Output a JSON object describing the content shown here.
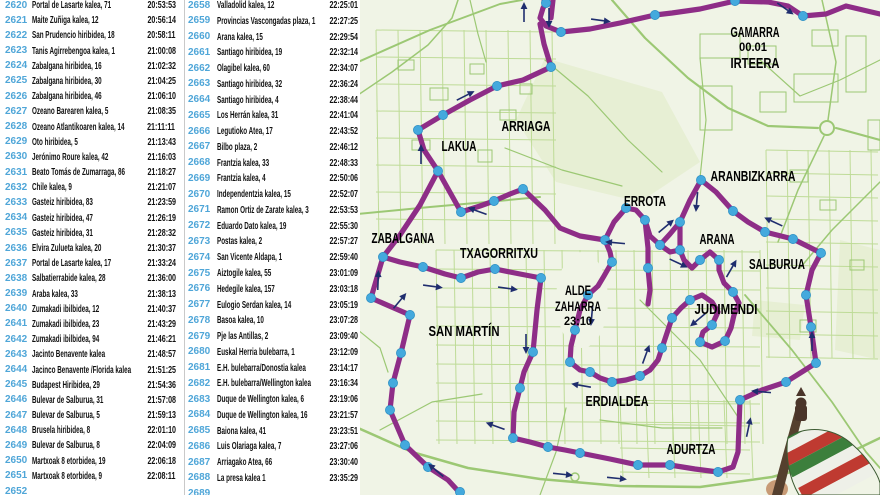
{
  "table": {
    "left_rows": [
      {
        "num": "2620",
        "name": "Portal de Lasarte kalea, 71",
        "time": "20:53:53"
      },
      {
        "num": "2621",
        "name": "Maite Zuñiga kalea, 12",
        "time": "20:56:14"
      },
      {
        "num": "2622",
        "name": "San Prudencio hiribidea, 18",
        "time": "20:58:11"
      },
      {
        "num": "2623",
        "name": "Tanis Agirrebengoa kalea, 1",
        "time": "21:00:08"
      },
      {
        "num": "2624",
        "name": "Zabalgana hiribidea, 16",
        "time": "21:02:32"
      },
      {
        "num": "2625",
        "name": "Zabalgana hiribidea, 30",
        "time": "21:04:25"
      },
      {
        "num": "2626",
        "name": "Zabalgana hiribidea, 46",
        "time": "21:06:10"
      },
      {
        "num": "2627",
        "name": "Ozeano Barearen kalea, 5",
        "time": "21:08:35"
      },
      {
        "num": "2628",
        "name": "Ozeano Atlantikoaren kalea, 14",
        "time": "21:11:11"
      },
      {
        "num": "2629",
        "name": "Oto hiribidea, 5",
        "time": "21:13:43"
      },
      {
        "num": "2630",
        "name": "Jerónimo Roure kalea, 42",
        "time": "21:16:03"
      },
      {
        "num": "2631",
        "name": "Beato Tomás de Zumarraga, 86",
        "time": "21:18:27"
      },
      {
        "num": "2632",
        "name": "Chile kalea, 9",
        "time": "21:21:07"
      },
      {
        "num": "2633",
        "name": "Gasteiz hiribidea, 83",
        "time": "21:23:59"
      },
      {
        "num": "2634",
        "name": "Gasteiz hiribidea, 47",
        "time": "21:26:19"
      },
      {
        "num": "2635",
        "name": "Gasteiz hiribidea, 31",
        "time": "21:28:32"
      },
      {
        "num": "2636",
        "name": "Elvira Zulueta kalea, 20",
        "time": "21:30:37"
      },
      {
        "num": "2637",
        "name": "Portal de Lasarte kalea, 17",
        "time": "21:33:24"
      },
      {
        "num": "2638",
        "name": "Salbatierrabide kalea, 28",
        "time": "21:36:00"
      },
      {
        "num": "2639",
        "name": "Araba kalea, 33",
        "time": "21:38:13"
      },
      {
        "num": "2640",
        "name": "Zumakadi ibilbidea, 12",
        "time": "21:40:37"
      },
      {
        "num": "2641",
        "name": "Zumakadi ibilbidea, 23",
        "time": "21:43:29"
      },
      {
        "num": "2642",
        "name": "Zumakadi ibilbidea, 94",
        "time": "21:46:21"
      },
      {
        "num": "2643",
        "name": "Jacinto Benavente kalea",
        "time": "21:48:57"
      },
      {
        "num": "2644",
        "name": "Jacinco Benavente /Florida kalea",
        "time": "21:51:25"
      },
      {
        "num": "2645",
        "name": "Budapest Hiribidea, 29",
        "time": "21:54:36"
      },
      {
        "num": "2646",
        "name": "Bulevar de Salburua, 31",
        "time": "21:57:08"
      },
      {
        "num": "2647",
        "name": "Bulevar de Salburua, 5",
        "time": "21:59:13"
      },
      {
        "num": "2648",
        "name": "Brusela hiribidea, 8",
        "time": "22:01:10"
      },
      {
        "num": "2649",
        "name": "Bulevar de Salburua, 8",
        "time": "22:04:09"
      },
      {
        "num": "2650",
        "name": "Martxoak 8 etorbidea, 19",
        "time": "22:06:18"
      },
      {
        "num": "2651",
        "name": "Martxoak 8 etorbidea, 9",
        "time": "22:08:11"
      }
    ],
    "left_partial": {
      "num": "2652",
      "name": "",
      "time": ""
    },
    "right_rows": [
      {
        "num": "2658",
        "name": "Valladolid kalea, 12",
        "time": "22:25:01"
      },
      {
        "num": "2659",
        "name": "Provincias Vascongadas plaza, 1",
        "time": "22:27:25"
      },
      {
        "num": "2660",
        "name": "Arana kalea, 15",
        "time": "22:29:54"
      },
      {
        "num": "2661",
        "name": "Santiago hiribidea, 19",
        "time": "22:32:14"
      },
      {
        "num": "2662",
        "name": "Olagibel kalea, 60",
        "time": "22:34:07"
      },
      {
        "num": "2663",
        "name": "Santiago hiribidea, 32",
        "time": "22:36:24"
      },
      {
        "num": "2664",
        "name": "Santiago hiribidea, 4",
        "time": "22:38:44"
      },
      {
        "num": "2665",
        "name": "Los Herrán kalea, 31",
        "time": "22:41:04"
      },
      {
        "num": "2666",
        "name": "Legutioko Atea, 17",
        "time": "22:43:52"
      },
      {
        "num": "2667",
        "name": "Bilbo plaza, 2",
        "time": "22:46:12"
      },
      {
        "num": "2668",
        "name": "Frantzia kalea, 33",
        "time": "22:48:33"
      },
      {
        "num": "2669",
        "name": "Frantzia kalea, 4",
        "time": "22:50:06"
      },
      {
        "num": "2670",
        "name": "Independentzia kalea, 15",
        "time": "22:52:07"
      },
      {
        "num": "2671",
        "name": "Ramon Ortiz de Zarate kalea, 3",
        "time": "22:53:53"
      },
      {
        "num": "2672",
        "name": "Eduardo Dato kalea, 19",
        "time": "22:55:30"
      },
      {
        "num": "2673",
        "name": "Postas kalea, 2",
        "time": "22:57:27"
      },
      {
        "num": "2674",
        "name": "San Vicente Aldapa, 1",
        "time": "22:59:40"
      },
      {
        "num": "2675",
        "name": "Aiztogile kalea, 55",
        "time": "23:01:09"
      },
      {
        "num": "2676",
        "name": "Hedegile kalea, 157",
        "time": "23:03:18"
      },
      {
        "num": "2677",
        "name": "Eulogio Serdan kalea, 14",
        "time": "23:05:19"
      },
      {
        "num": "2678",
        "name": "Basoa kalea, 10",
        "time": "23:07:28"
      },
      {
        "num": "2679",
        "name": "Pje las Antillas, 2",
        "time": "23:09:40"
      },
      {
        "num": "2680",
        "name": "Euskal Herria bulebarra, 1",
        "time": "23:12:09"
      },
      {
        "num": "2681",
        "name": "E.H. bulebarra/Donostia kalea",
        "time": "23:14:17"
      },
      {
        "num": "2682",
        "name": "E.H. bulebarra/Wellington kalea",
        "time": "23:16:34"
      },
      {
        "num": "2683",
        "name": "Duque de Wellington kalea, 6",
        "time": "23:19:06"
      },
      {
        "num": "2684",
        "name": "Duque de Wellington kalea, 16",
        "time": "23:21:57"
      },
      {
        "num": "2685",
        "name": "Baiona kalea, 41",
        "time": "23:23:51"
      },
      {
        "num": "2686",
        "name": "Luis Olariaga kalea, 7",
        "time": "23:27:06"
      },
      {
        "num": "2687",
        "name": "Arriagako Atea, 66",
        "time": "23:30:40"
      },
      {
        "num": "2688",
        "name": "La presa kalea 1",
        "time": "23:35:29"
      }
    ],
    "right_partial": {
      "num": "2689",
      "name": "",
      "time": ""
    }
  },
  "map": {
    "labels": [
      {
        "id": "gamarra",
        "text": "GAMARRA"
      },
      {
        "id": "km-marker",
        "text": "00.01"
      },
      {
        "id": "irteera",
        "text": "IRTEERA"
      },
      {
        "id": "arriaga",
        "text": "ARRIAGA"
      },
      {
        "id": "lakua",
        "text": "LAKUA"
      },
      {
        "id": "zabalgana",
        "text": "ZABALGANA"
      },
      {
        "id": "txagorritxu",
        "text": "TXAGORRITXU"
      },
      {
        "id": "errota",
        "text": "ERROTA"
      },
      {
        "id": "aranbizkarra",
        "text": "ARANBIZKARRA"
      },
      {
        "id": "arana",
        "text": "ARANA"
      },
      {
        "id": "salburua",
        "text": "SALBURUA"
      },
      {
        "id": "alde-zaharra-line1",
        "text": "ALDE"
      },
      {
        "id": "alde-zaharra-line2",
        "text": "ZAHARRA"
      },
      {
        "id": "alde-zaharra-time",
        "text": "23:10"
      },
      {
        "id": "judimendi",
        "text": "JUDIMENDI"
      },
      {
        "id": "san-martin",
        "text": "SAN MARTÍN"
      },
      {
        "id": "erdialdea",
        "text": "ERDIALDEA"
      },
      {
        "id": "adurtza",
        "text": "ADURTZA"
      }
    ],
    "colors": {
      "route": "#8E2D87",
      "node": "#44A9DD",
      "node_edge": "#2B8EC2",
      "arrow": "#1F2D6E",
      "road": "#9CC874",
      "road_light": "#BEDB97",
      "park": "#E7EFD4",
      "bg": "#F0F4E6",
      "label": "#000000"
    }
  },
  "colors": {
    "row_number": "#4FA6D8",
    "divider": "#C9C9C9",
    "text": "#111111"
  }
}
